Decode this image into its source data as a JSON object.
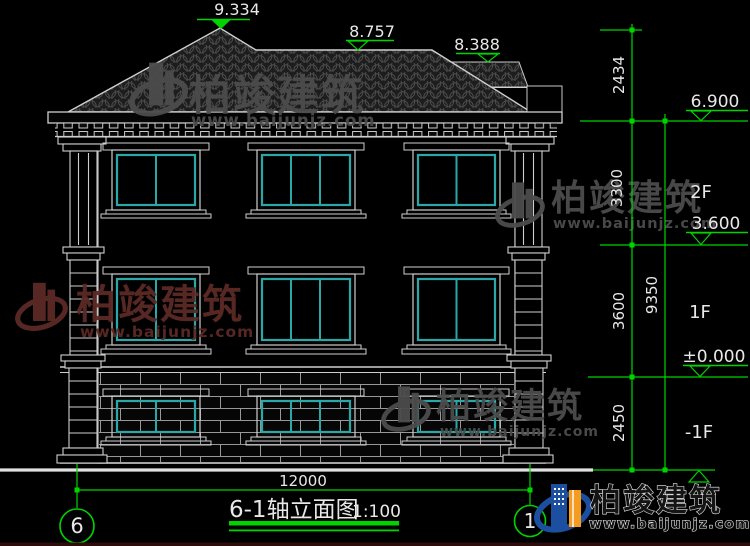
{
  "drawing": {
    "title": "6-1轴立面图",
    "scale": "1:100",
    "width_dim": "12000",
    "axis_start": "6",
    "axis_end": "1"
  },
  "levels": {
    "roof_peak": "9.334",
    "roof_ridge": "8.757",
    "roof_side": "8.388",
    "floor2_top": "6.900",
    "floor2": "3.600",
    "ground": "±0.000"
  },
  "heights": {
    "seg_roof": "2434",
    "seg_2f": "3300",
    "seg_1f": "3600",
    "seg_b1": "2450",
    "total": "9350"
  },
  "floors": {
    "f2": "2F",
    "f1": "1F",
    "b1": "-1F"
  },
  "watermark": {
    "brand": "柏竣建筑",
    "site": "www.baijunjz.com"
  },
  "colors": {
    "dim_green": "#00d400",
    "window_teal": "#2aa7a7",
    "line_white": "#d6d6d6",
    "watermark_gray": "#4c4c4c",
    "watermark_maroon": "#5c2a25",
    "logo_blue": "#1c4f9f",
    "logo_orange": "#f59b1f"
  }
}
